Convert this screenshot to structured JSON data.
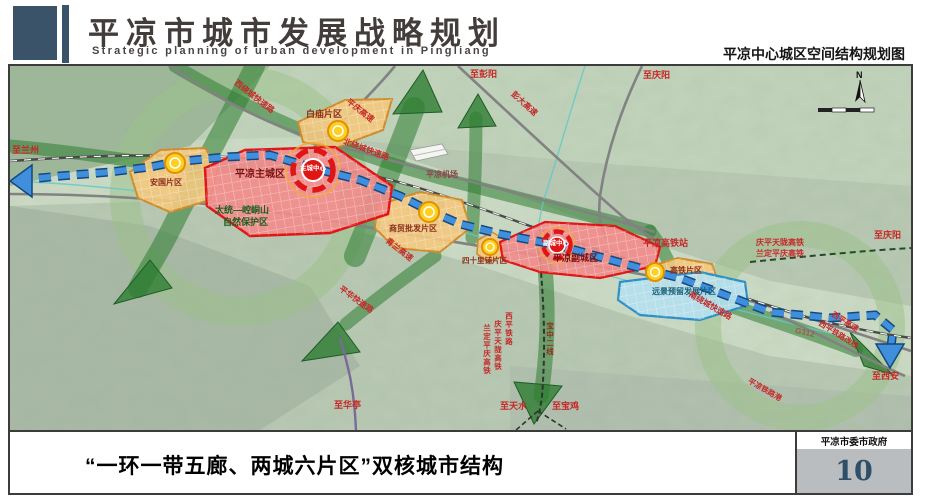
{
  "header": {
    "title": "平凉市城市发展战略规划",
    "subtitle": "Strategic planning of urban development in Pingliang",
    "map_title": "平凉中心城区空间结构规划图"
  },
  "map": {
    "compass_n": "N",
    "labels": {
      "to_lanzhou": "至兰州",
      "nature_reserve_1": "太统—崆峒山",
      "nature_reserve_2": "自然保护区",
      "west_ring_expressway": "西绕城快速路",
      "baimiao_district": "白庙片区",
      "pingqing_expressway": "平庆高速",
      "north_ring_expressway": "北绕城快速路",
      "to_pengyang": "至彭阳",
      "pengda_expressway": "彭大高速",
      "to_qingyang_north": "至庆阳",
      "pingliang_airport": "平凉机场",
      "anguo_district": "安国片区",
      "main_city": "平凉主城区",
      "main_city_center": "主城中心",
      "trade_district": "商贸批发片区",
      "qinglan_expressway": "青兰高速",
      "sishilipu_district": "四十里铺片区",
      "east_city": "平凉副城区",
      "east_city_center": "副城中心",
      "hsr_station": "平凉高铁站",
      "qingping_tianlong_hsr": "庆平天陇高铁",
      "landing_pingqing_hsr": "兰定平庆高铁",
      "to_qingyang_east": "至庆阳",
      "hsr_district": "高铁片区",
      "reserved_district": "远景预留发展片区",
      "south_ring_expressway": "南绕城快速路",
      "g312": "G312",
      "xiping_expressway": "西平高速",
      "xiping_rail_realignment": "西平铁路改线",
      "to_xian": "至西安",
      "railway_port": "平凉铁路港",
      "v_landing_pingqing_hsr": "兰定平庆高铁",
      "v_qingping_tianlong_hsr": "庆平天陇高铁",
      "v_xiping_railway": "西平铁路",
      "v_baozhong_line": "宝中二线",
      "to_huating": "至华亭",
      "to_tianshui": "至天水",
      "to_baoji": "至宝鸡",
      "pinghua_expressway": "平华快速路"
    }
  },
  "footer": {
    "caption": "“一环一带五廊、两城六片区”双核城市结构",
    "org": "平凉市委市政府",
    "page": "10"
  },
  "colors": {
    "header_accent": "#3a5368",
    "axis_blue": "#3f8fdd",
    "corridor_green": "#2e7d32",
    "core_red": "#e01515",
    "district_orange": "#f3c87e",
    "node_yellow": "#ffd024",
    "reserved_blue": "#b5e0ef",
    "page_number": "#2f4f68"
  }
}
